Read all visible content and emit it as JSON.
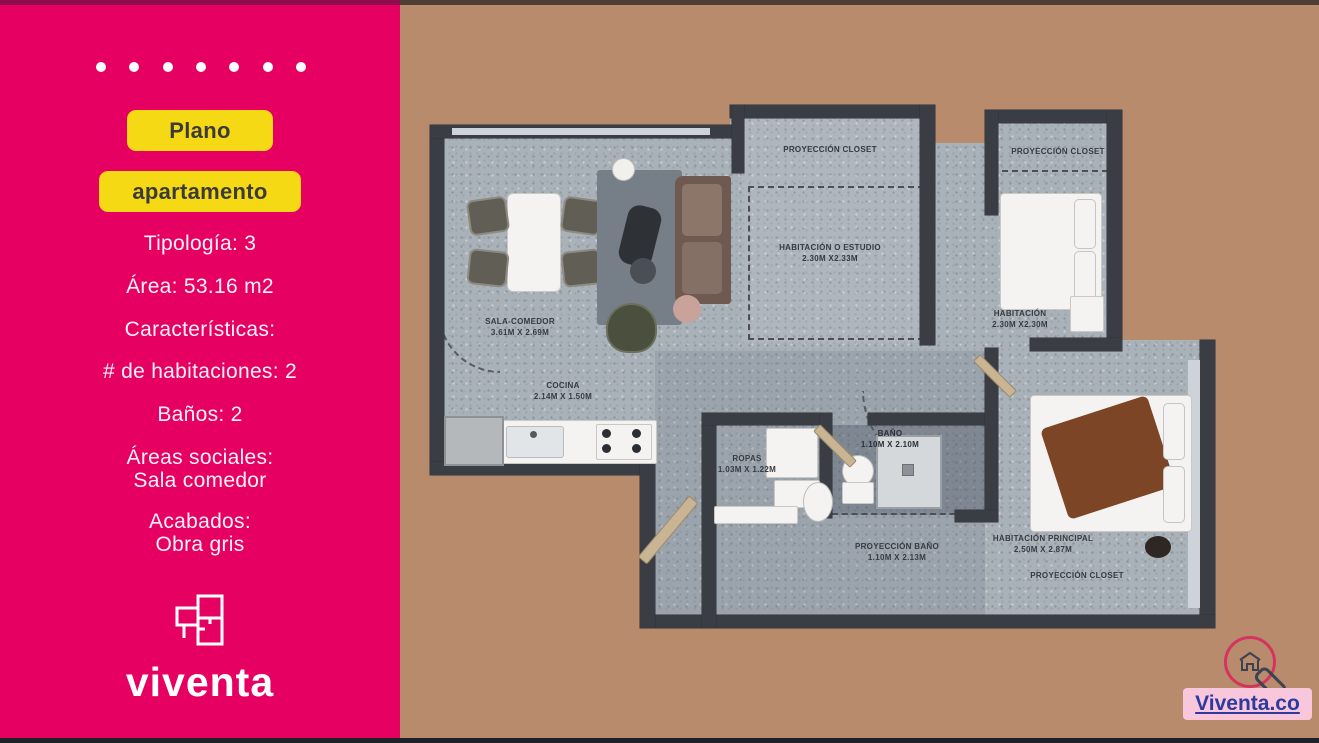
{
  "sidebar": {
    "badge_primary": "Plano",
    "badge_secondary": "apartamento",
    "specs": {
      "tipologia": "Tipología: 3",
      "area": "Área: 53.16  m2",
      "caracteristicas": "Características:",
      "habitaciones": "#  de habitaciones: 2",
      "banos": "Baños: 2",
      "areas_sociales": "Áreas sociales:",
      "areas_sociales_value": "Sala comedor",
      "acabados": "Acabados:",
      "acabados_value": "Obra gris"
    },
    "logo_text": "viventa"
  },
  "plan": {
    "labels": {
      "proyeccion_closet_estudio": "PROYECCIÓN CLOSET",
      "estudio_name": "HABITACIÓN  O ESTUDIO",
      "estudio_dims": "2.30M X2.33M",
      "proyeccion_closet_hab2": "PROYECCIÓN CLOSET",
      "hab2_name": "HABITACIÓN",
      "hab2_dims": "2.30M X2.30M",
      "sala_name": "SALA-COMEDOR",
      "sala_dims": "3.61M X 2.69M",
      "cocina_name": "COCINA",
      "cocina_dims": "2.14M X 1.50M",
      "ropas_name": "ROPAS",
      "ropas_dims": "1.03M X 1.22M",
      "bano_name": "BAÑO",
      "bano_dims": "1.10M X 2.10M",
      "proyeccion_bano_name": "PROYECCIÓN  BAÑO",
      "proyeccion_bano_dims": "1.10M X 2.13M",
      "principal_name": "HABITACIÓN  PRINCIPAL",
      "principal_dims": "2.50M X 2.87M",
      "proyeccion_closet_principal": "PROYECCIÓN CLOSET"
    }
  },
  "footer": {
    "site_link": "Viventa.co"
  },
  "colors": {
    "pink": "#E60062",
    "yellow": "#F6D915",
    "tan": "#B78B6C",
    "wall": "#3A3E44",
    "badge_bg": "#F9C7DB",
    "badge_text": "#2D3A9E"
  }
}
